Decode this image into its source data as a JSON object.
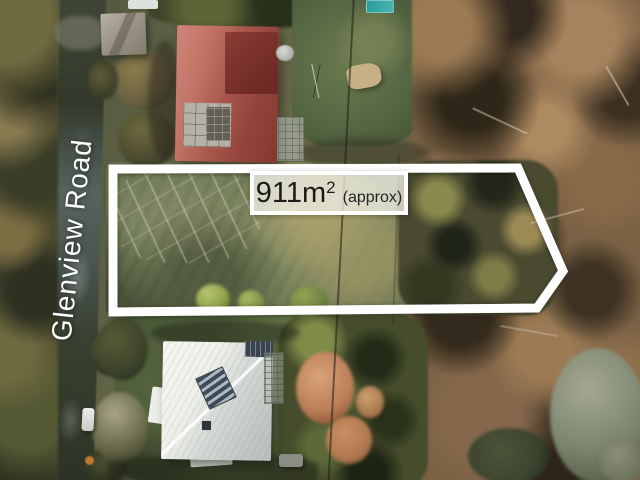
{
  "overlay": {
    "road_label": "Glenview Road",
    "area_value": "911m",
    "area_superscript": "2",
    "area_qualifier": "(approx)",
    "boundary_color": "#ffffff"
  },
  "palette": {
    "label_text": "#1b1b19",
    "label_background": "#f0efe6",
    "red_roof": "#a8564a",
    "white_roof": "#e8eae5",
    "lot_grass": "#74805a",
    "forest": "#7b6142",
    "road": "#3a4233",
    "pool": "#35a8a2"
  }
}
